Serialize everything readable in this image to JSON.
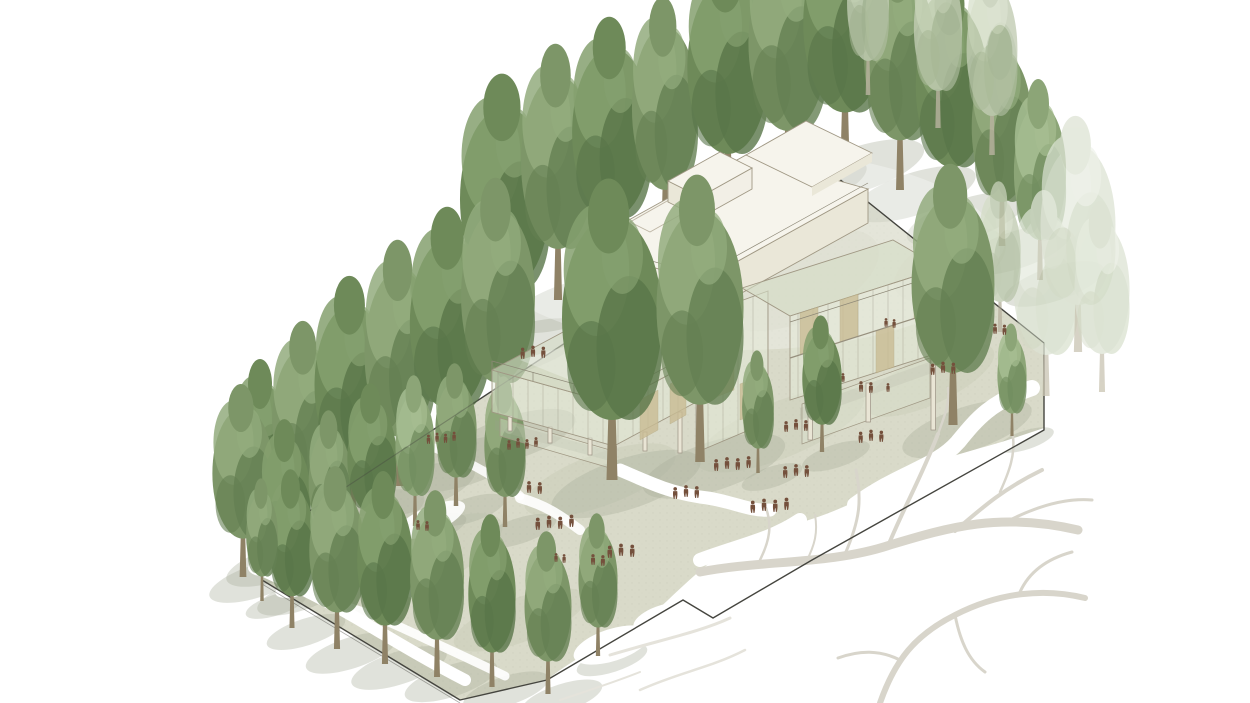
{
  "scene": {
    "title": "Architectural axonometric site illustration",
    "subtitle": "Glass pavilion with white roof volumes among columnar poplar trees on a diamond-shaped plot",
    "no_visible_text": true,
    "palette": {
      "background": "#ffffff",
      "boundary_line": "#45453f",
      "ground": "#d9dac9",
      "ground_shade": "#c2c6b0",
      "tree_shadow": "#a9ae9b",
      "path_white": "#ffffff",
      "building_white": "#f2efe6",
      "building_roof": "#f6f4ec",
      "building_face_shade": "#eae7d8",
      "building_edge": "#a09884",
      "glass": "#e4e9d8",
      "mullion": "#8d8877",
      "panel_tan": "#c9bc94",
      "figure_brown": "#74503c",
      "branch_grey": "#d8d5cb",
      "branch_faint": "#e5e3db",
      "trunk": "#8f8266",
      "tree_mid": "#7d9668",
      "tree_light": "#93ac7e",
      "tree_dark": "#647f52",
      "tree_faded": "#ccd5c0"
    },
    "site": {
      "shape": "irregular diamond plot outlined by a thin dark boundary line with a stepped lower edge",
      "boundary_points": "828,170 1044,343 1044,430 812,560 713,618 683,600 547,680 460,700 262,580 258,545"
    },
    "building": {
      "storeys": 3,
      "wings": 2,
      "features": [
        "white flat-roof top volume with raised penthouse box and roof hatch",
        "stepped translucent glass facades with tan weave panels",
        "second-floor terrace with railing and people",
        "recessed glass ground floor on slender pilotis"
      ]
    },
    "vegetation": {
      "tree_type": "columnar poplar",
      "tree_count": 45,
      "rows": [
        "dense row along upper-left boundary",
        "row along lower-left boundary",
        "faded trees outside right boundary",
        "large courtyard trees in front of the building"
      ]
    },
    "people": {
      "total": 63,
      "color": "#74503c",
      "description": "small walking and standing silhouettes on terraces, balconies and ground"
    },
    "branches": {
      "description": "pale bare tree-branch silhouettes across the white paved area at bottom right"
    },
    "trees": [
      {
        "x": 505,
        "y": 345,
        "h": 270,
        "w": 1.15,
        "v": "dark",
        "l": "back"
      },
      {
        "x": 558,
        "y": 300,
        "h": 255,
        "w": 1.0,
        "v": "mid",
        "l": "back"
      },
      {
        "x": 612,
        "y": 268,
        "h": 250,
        "w": 1.1,
        "v": "dark",
        "l": "back"
      },
      {
        "x": 665,
        "y": 238,
        "h": 240,
        "w": 0.95,
        "v": "mid",
        "l": "back"
      },
      {
        "x": 728,
        "y": 205,
        "h": 255,
        "w": 1.1,
        "v": "dark",
        "l": "back"
      },
      {
        "x": 788,
        "y": 183,
        "h": 260,
        "w": 1.05,
        "v": "mid",
        "l": "back"
      },
      {
        "x": 845,
        "y": 165,
        "h": 262,
        "w": 1.1,
        "v": "dark",
        "l": "back"
      },
      {
        "x": 900,
        "y": 190,
        "h": 248,
        "w": 1.0,
        "v": "mid",
        "l": "back"
      },
      {
        "x": 952,
        "y": 215,
        "h": 238,
        "w": 1.05,
        "v": "dark",
        "l": "back"
      },
      {
        "x": 1002,
        "y": 246,
        "h": 220,
        "w": 0.95,
        "v": "mid",
        "l": "back"
      },
      {
        "x": 1040,
        "y": 280,
        "h": 200,
        "w": 0.9,
        "v": "light",
        "l": "back"
      },
      {
        "x": 938,
        "y": 128,
        "h": 185,
        "w": 0.9,
        "v": "faded",
        "l": "back"
      },
      {
        "x": 992,
        "y": 155,
        "h": 195,
        "w": 0.9,
        "v": "faded",
        "l": "back"
      },
      {
        "x": 868,
        "y": 95,
        "h": 170,
        "w": 0.85,
        "v": "faded",
        "l": "back"
      },
      {
        "x": 262,
        "y": 560,
        "h": 200,
        "w": 1.0,
        "v": "dark",
        "l": "back"
      },
      {
        "x": 305,
        "y": 537,
        "h": 215,
        "w": 1.05,
        "v": "mid",
        "l": "back"
      },
      {
        "x": 352,
        "y": 512,
        "h": 235,
        "w": 1.1,
        "v": "dark",
        "l": "back"
      },
      {
        "x": 400,
        "y": 486,
        "h": 245,
        "w": 1.0,
        "v": "mid",
        "l": "back"
      },
      {
        "x": 450,
        "y": 460,
        "h": 252,
        "w": 1.1,
        "v": "dark",
        "l": "back"
      },
      {
        "x": 498,
        "y": 434,
        "h": 255,
        "w": 1.0,
        "v": "mid",
        "l": "back"
      },
      {
        "x": 243,
        "y": 577,
        "h": 192,
        "w": 1.1,
        "v": "mid",
        "l": "back"
      },
      {
        "x": 286,
        "y": 592,
        "h": 172,
        "w": 1.0,
        "v": "dark",
        "l": "back"
      },
      {
        "x": 330,
        "y": 566,
        "h": 155,
        "w": 0.95,
        "v": "mid",
        "l": "back"
      },
      {
        "x": 372,
        "y": 546,
        "h": 162,
        "w": 1.05,
        "v": "dark",
        "l": "back"
      },
      {
        "x": 415,
        "y": 526,
        "h": 150,
        "w": 0.9,
        "v": "light",
        "l": "back"
      },
      {
        "x": 456,
        "y": 506,
        "h": 142,
        "w": 1.0,
        "v": "mid",
        "l": "back"
      },
      {
        "x": 505,
        "y": 527,
        "h": 150,
        "w": 0.95,
        "v": "mid",
        "l": "back"
      },
      {
        "x": 1046,
        "y": 396,
        "h": 205,
        "w": 1.1,
        "v": "ghost",
        "l": "back"
      },
      {
        "x": 1078,
        "y": 352,
        "h": 235,
        "w": 1.1,
        "v": "ghost",
        "l": "back"
      },
      {
        "x": 1102,
        "y": 392,
        "h": 190,
        "w": 1.0,
        "v": "ghost",
        "l": "back"
      },
      {
        "x": 1000,
        "y": 332,
        "h": 150,
        "w": 0.95,
        "v": "faded",
        "l": "back"
      },
      {
        "x": 292,
        "y": 628,
        "h": 158,
        "w": 1.0,
        "v": "dark",
        "l": "front"
      },
      {
        "x": 337,
        "y": 649,
        "h": 182,
        "w": 1.05,
        "v": "mid",
        "l": "front"
      },
      {
        "x": 385,
        "y": 664,
        "h": 192,
        "w": 1.0,
        "v": "dark",
        "l": "front"
      },
      {
        "x": 437,
        "y": 677,
        "h": 186,
        "w": 1.0,
        "v": "mid",
        "l": "front"
      },
      {
        "x": 492,
        "y": 687,
        "h": 172,
        "w": 0.95,
        "v": "dark",
        "l": "front"
      },
      {
        "x": 548,
        "y": 694,
        "h": 162,
        "w": 1.0,
        "v": "mid",
        "l": "front"
      },
      {
        "x": 262,
        "y": 601,
        "h": 122,
        "w": 0.9,
        "v": "mid",
        "l": "front"
      },
      {
        "x": 598,
        "y": 656,
        "h": 142,
        "w": 0.95,
        "v": "mid",
        "l": "front"
      },
      {
        "x": 612,
        "y": 480,
        "h": 300,
        "w": 1.15,
        "v": "dark",
        "l": "front"
      },
      {
        "x": 700,
        "y": 462,
        "h": 286,
        "w": 1.05,
        "v": "mid",
        "l": "front"
      },
      {
        "x": 953,
        "y": 425,
        "h": 260,
        "w": 1.1,
        "v": "mid",
        "l": "front"
      },
      {
        "x": 822,
        "y": 452,
        "h": 136,
        "w": 1.0,
        "v": "dark",
        "l": "front"
      },
      {
        "x": 758,
        "y": 473,
        "h": 122,
        "w": 0.9,
        "v": "mid",
        "l": "front"
      },
      {
        "x": 1012,
        "y": 436,
        "h": 112,
        "w": 0.9,
        "v": "light",
        "l": "front"
      }
    ],
    "figure_groups": [
      {
        "x": 533,
        "y": 357,
        "n": 3,
        "s": 1.15,
        "l": "building"
      },
      {
        "x": 586,
        "y": 397,
        "n": 2,
        "s": 1.15,
        "l": "building"
      },
      {
        "x": 598,
        "y": 288,
        "n": 2,
        "s": 0.85,
        "l": "building"
      },
      {
        "x": 886,
        "y": 327,
        "n": 2,
        "s": 0.9,
        "l": "building"
      },
      {
        "x": 927,
        "y": 314,
        "n": 2,
        "s": 0.9,
        "l": "building"
      },
      {
        "x": 843,
        "y": 382,
        "n": 1,
        "s": 0.9,
        "l": "building"
      },
      {
        "x": 518,
        "y": 448,
        "n": 4,
        "s": 1.0,
        "l": "building"
      },
      {
        "x": 437,
        "y": 442,
        "n": 4,
        "s": 0.95,
        "l": "ground"
      },
      {
        "x": 529,
        "y": 493,
        "n": 2,
        "s": 1.2,
        "l": "ground"
      },
      {
        "x": 549,
        "y": 528,
        "n": 4,
        "s": 1.25,
        "l": "ground"
      },
      {
        "x": 556,
        "y": 562,
        "n": 2,
        "s": 0.9,
        "l": "ground"
      },
      {
        "x": 593,
        "y": 565,
        "n": 2,
        "s": 1.1,
        "l": "ground"
      },
      {
        "x": 621,
        "y": 556,
        "n": 3,
        "s": 1.25,
        "l": "ground"
      },
      {
        "x": 686,
        "y": 497,
        "n": 3,
        "s": 1.2,
        "l": "ground"
      },
      {
        "x": 727,
        "y": 469,
        "n": 4,
        "s": 1.2,
        "l": "ground"
      },
      {
        "x": 764,
        "y": 511,
        "n": 4,
        "s": 1.25,
        "l": "ground"
      },
      {
        "x": 796,
        "y": 476,
        "n": 3,
        "s": 1.2,
        "l": "ground"
      },
      {
        "x": 796,
        "y": 430,
        "n": 3,
        "s": 1.1,
        "l": "ground"
      },
      {
        "x": 861,
        "y": 392,
        "n": 2,
        "s": 1.1,
        "l": "ground"
      },
      {
        "x": 943,
        "y": 373,
        "n": 3,
        "s": 1.15,
        "l": "ground"
      },
      {
        "x": 995,
        "y": 334,
        "n": 2,
        "s": 1.05,
        "l": "ground"
      },
      {
        "x": 871,
        "y": 441,
        "n": 3,
        "s": 1.15,
        "l": "ground"
      },
      {
        "x": 888,
        "y": 392,
        "n": 1,
        "s": 0.9,
        "l": "ground"
      },
      {
        "x": 418,
        "y": 530,
        "n": 2,
        "s": 1.0,
        "l": "ground"
      }
    ]
  }
}
